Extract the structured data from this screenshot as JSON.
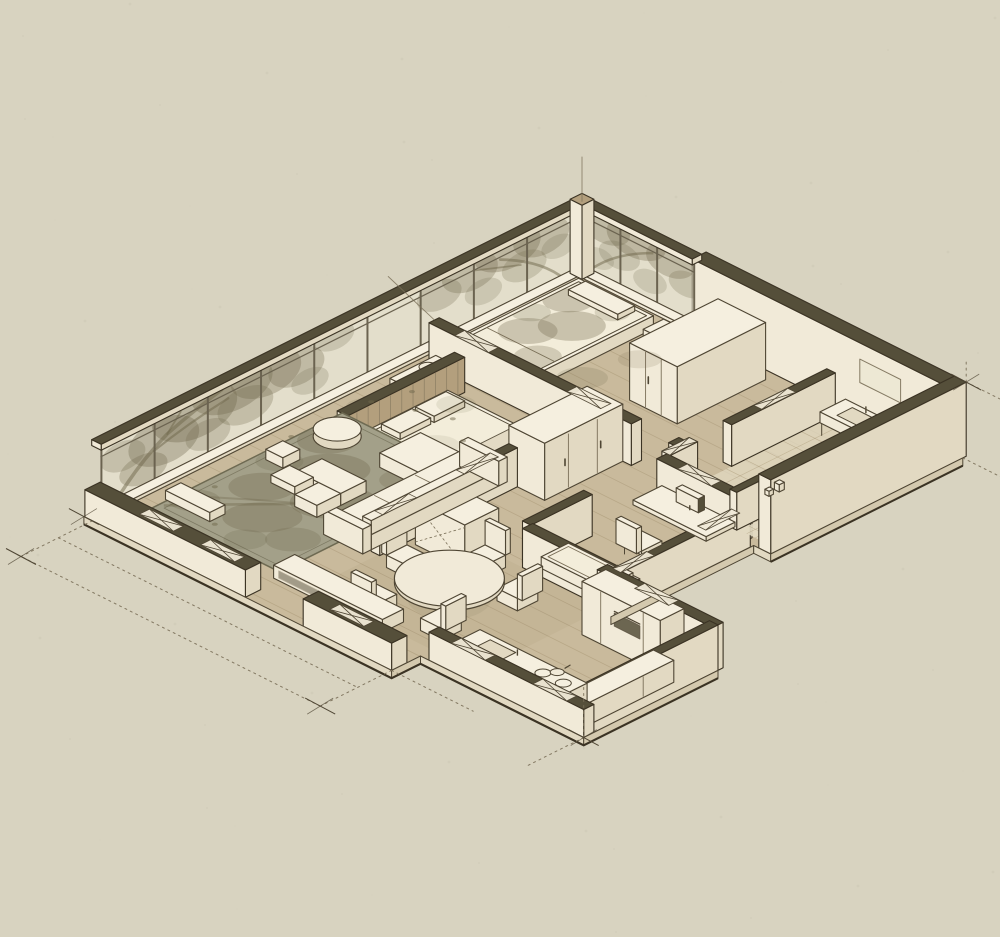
{
  "image": {
    "kind": "hand-drawn isometric cutaway floor plan sketch",
    "medium": "sepia ink and watercolor wash on warm paper",
    "subject": "apartment interior axonometric with tree shadows on glass walls"
  },
  "palette": {
    "bg": "#d8d3c0",
    "paper": "#f1ead8",
    "paper_top": "#f5efdf",
    "paper_shade": "#e2d9c2",
    "paper_dark": "#d4c9ae",
    "ink": "#4f4634",
    "ink_soft": "#7a6f58",
    "outline": "#3b3324",
    "wall_cut": "#554f3a",
    "wall_cut_dark": "#3f3a2a",
    "floor_wood": "#c9ba9c",
    "floor_line": "#a3916f",
    "glass": "#ede8d4",
    "glass_frame": "#6b6350",
    "rug": "#a3a089",
    "rug_border": "#6e6a52",
    "shadow_tree": "#6f674c",
    "teal_accent": "#9fb2a6",
    "wood_slat": "#b39f7d",
    "duvet": "#f3edda"
  },
  "scene": {
    "building": "single-storey apartment shown cut away from above",
    "rooms": [
      {
        "name": "living room",
        "furniture": [
          "sectional sofa with chaise",
          "L-shaped coffee tables",
          "round pouf",
          "cube stool",
          "area rug with tree shadow",
          "window bench",
          "long media sideboard"
        ]
      },
      {
        "name": "dining area",
        "furniture": [
          "round pedestal table",
          "five chairs"
        ]
      },
      {
        "name": "kitchen",
        "furniture": [
          "L-shaped counter",
          "inset sink",
          "cooktop with pot",
          "tall cabinets with built-in oven",
          "half-height walls"
        ]
      },
      {
        "name": "master bedroom",
        "furniture": [
          "double bed with two pillows",
          "slatted headboard wall",
          "shelf unit with round washbasin",
          "double-door wardrobe",
          "teal runner"
        ]
      },
      {
        "name": "second bedroom",
        "furniture": [
          "bed with dappled sun duvet",
          "nightstand",
          "tall wardrobe",
          "teal runner"
        ]
      },
      {
        "name": "bathroom",
        "furniture": [
          "vanity with basin",
          "mirror",
          "toilet",
          "tiled walk-in shower",
          "ledge bottles"
        ]
      },
      {
        "name": "study",
        "furniture": [
          "built-in desk",
          "monitor",
          "desk chair",
          "daybed with pillow"
        ]
      }
    ],
    "features": [
      "floor-to-ceiling glass walls on two sides",
      "tree branch shadows cast over glass, rug and beds",
      "cut walls rendered with dark olive tops",
      "wood plank flooring",
      "dashed construction guide lines and corner ticks",
      "cross marks on wall tops"
    ]
  }
}
